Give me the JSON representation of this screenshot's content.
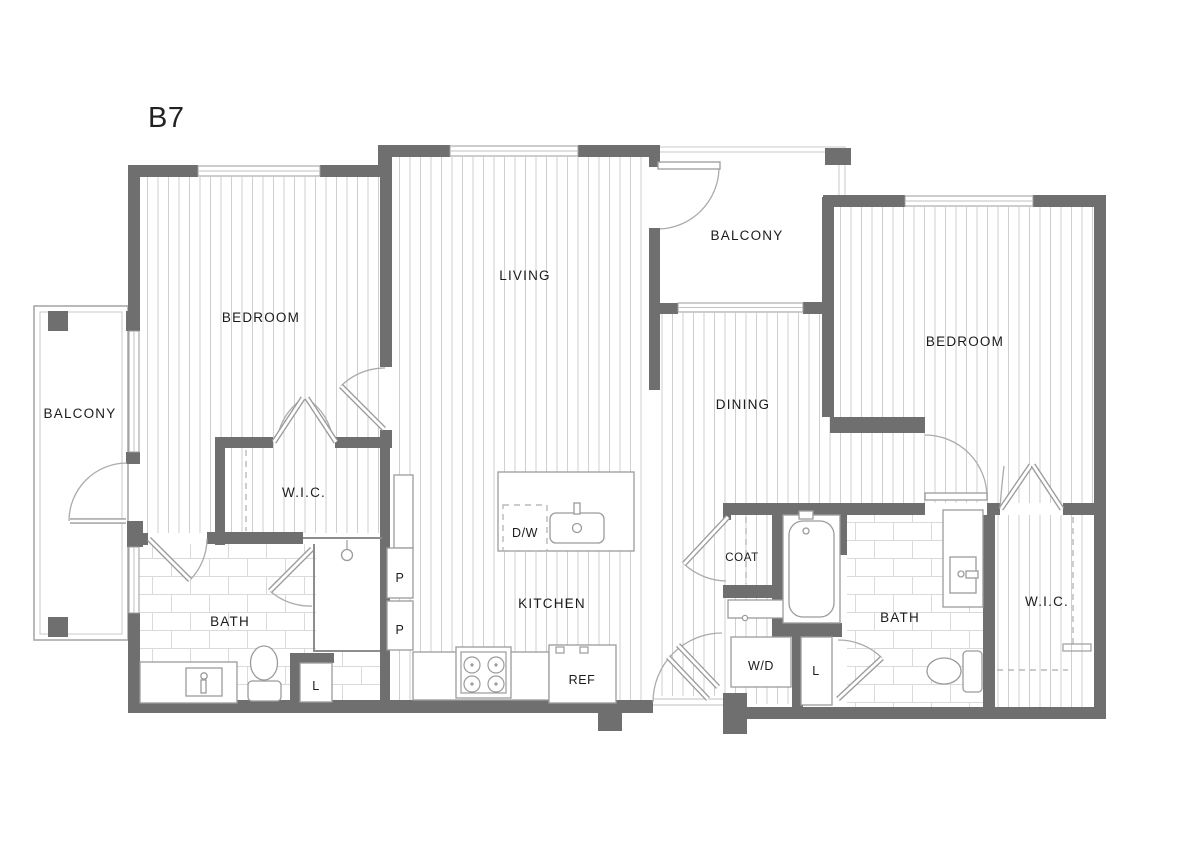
{
  "plan": {
    "unit_name": "B7",
    "rooms": {
      "bedroom_left": "BEDROOM",
      "balcony_left": "BALCONY",
      "wic_left": "W.I.C.",
      "bath_left": "BATH",
      "living": "LIVING",
      "balcony_top": "BALCONY",
      "dining": "DINING",
      "kitchen": "KITCHEN",
      "coat": "COAT",
      "bath_right": "BATH",
      "bedroom_right": "BEDROOM",
      "wic_right": "W.I.C."
    },
    "labels": {
      "dishwasher": "D/W",
      "refrigerator": "REF",
      "washer_dryer": "W/D",
      "pantry_top": "P",
      "pantry_bottom": "P",
      "linen_left": "L",
      "linen_right": "L"
    },
    "colors": {
      "wall": "#6f6f6f",
      "floor_hatch": "#cfcfcf",
      "tile_line": "#dadada",
      "fixture_line": "#9b9b9b",
      "text": "#1b1b1b",
      "background": "#ffffff"
    }
  }
}
